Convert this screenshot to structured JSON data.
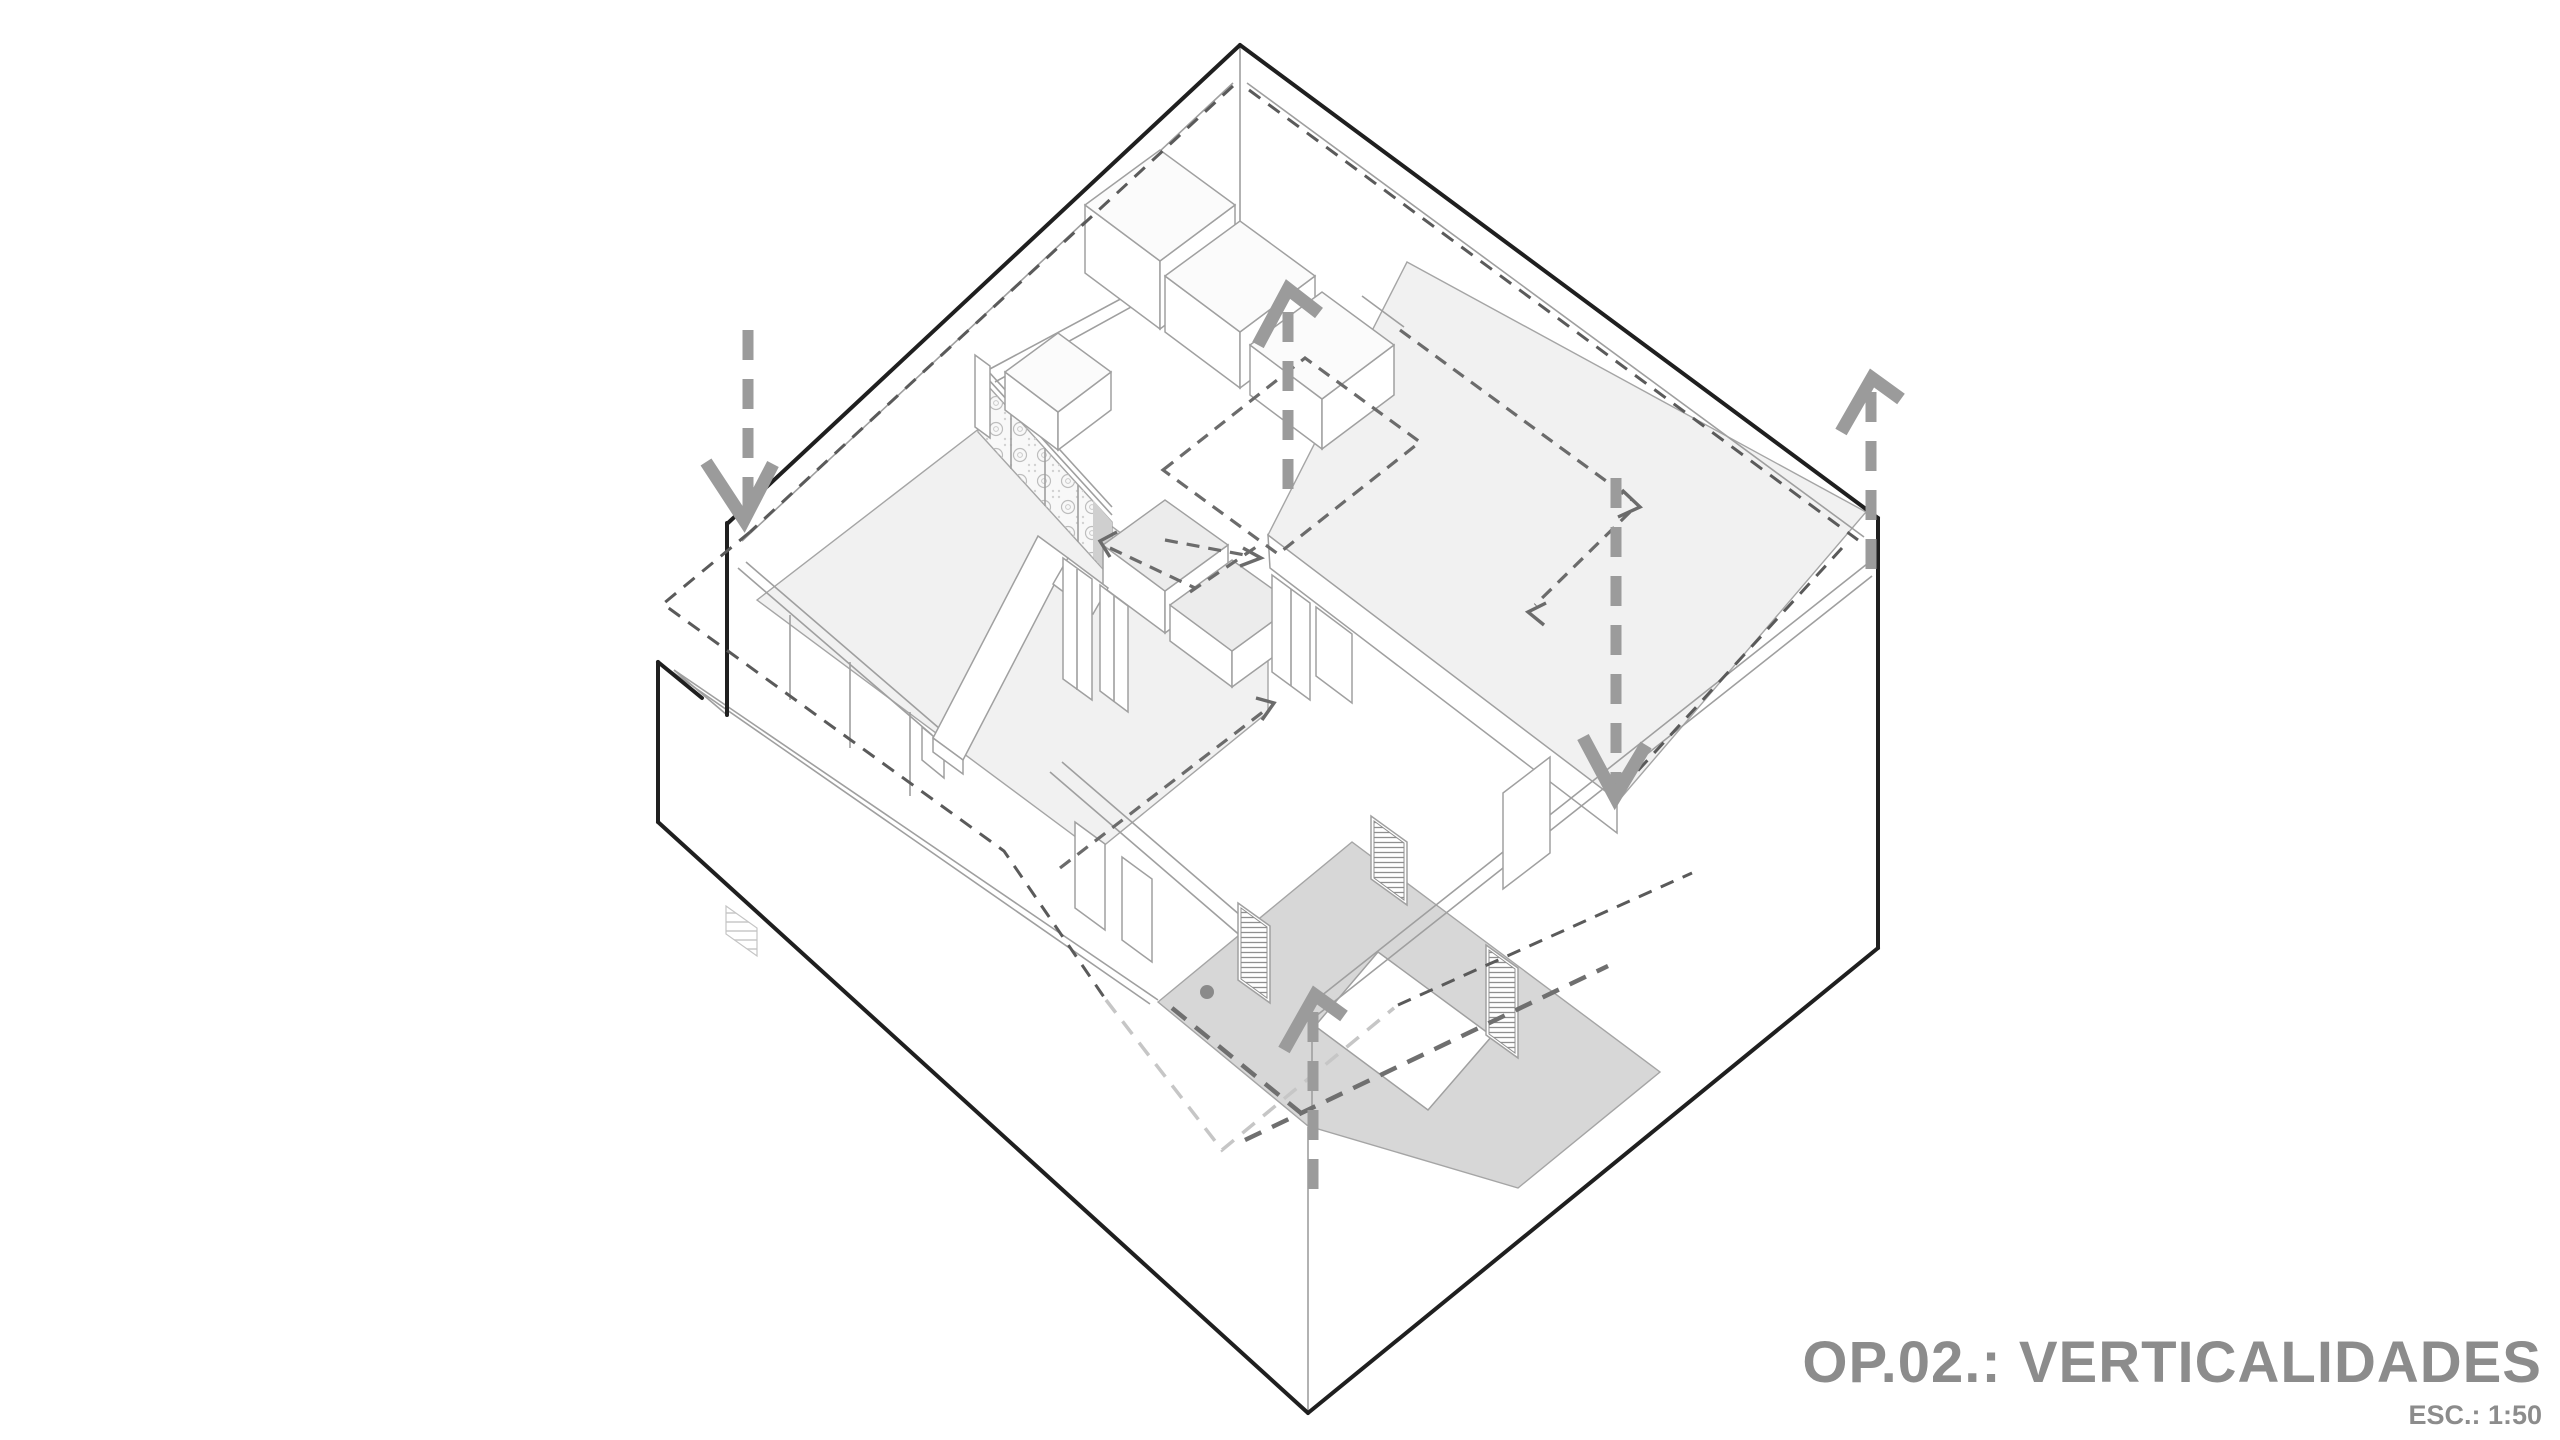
{
  "title": {
    "label": "OP.02.: VERTICALIDADES",
    "scale": "ESC.: 1:50",
    "color": "#8c8c8c"
  },
  "drawing": {
    "type": "axonometric-cutaway-floor-plan",
    "subject": "apartment unit with vertical circulation diagram",
    "colors": {
      "background": "#ffffff",
      "outer_wall_line": "#1f1f1f",
      "interior_line": "#9f9f9f",
      "floor_fill": "#f1f1f1",
      "courtyard_fill": "#d7d7d7",
      "vertical_arrow": "#9b9b9b",
      "circulation_dash": "#6b6b6b",
      "overhang_dash": "#5a5a5a",
      "overhang_dash_light": "#c6c6c6"
    },
    "vertical_arrows": [
      {
        "id": "arrow-down-upper-left",
        "direction": "down"
      },
      {
        "id": "arrow-up-center",
        "direction": "up"
      },
      {
        "id": "arrow-up-right",
        "direction": "up"
      },
      {
        "id": "arrow-down-center-right",
        "direction": "down"
      },
      {
        "id": "arrow-up-courtyard",
        "direction": "up"
      }
    ],
    "dashed_elements": [
      "roof-overhang-outline",
      "roof-overhang-outline-light",
      "circulation-rectangle-kitchen",
      "circulation-path-roof-steps",
      "circulation-path-room-diagonal",
      "circulation-path-courtyard"
    ]
  }
}
